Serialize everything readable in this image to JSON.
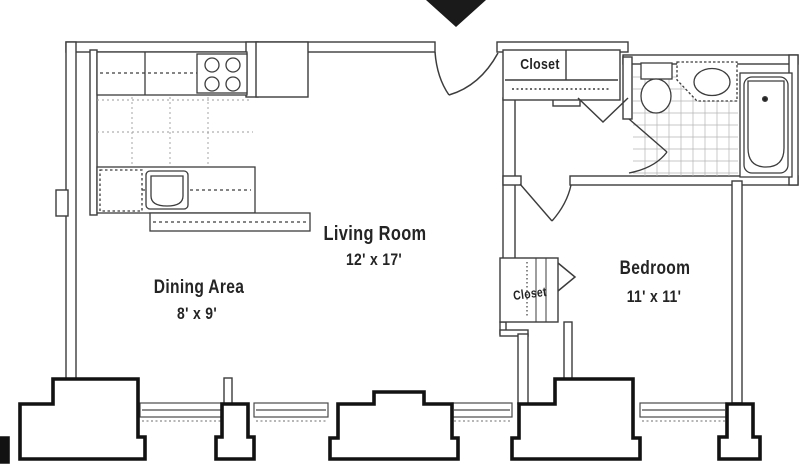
{
  "plan": {
    "title": "apartment-floor-plan",
    "rooms": [
      {
        "id": "living",
        "name": "Living Room",
        "dims": "12' x 17'"
      },
      {
        "id": "dining",
        "name": "Dining Area",
        "dims": "8' x 9'"
      },
      {
        "id": "bedroom",
        "name": "Bedroom",
        "dims": "11' x 11'"
      }
    ],
    "closets": {
      "entry_label": "Closet",
      "bedroom_label": "Closet"
    },
    "icons": {
      "entry_marker": "entry-arrow-icon",
      "stove": "stove-4-burner-icon",
      "kitchen_sink": "kitchen-sink-icon",
      "toilet": "toilet-icon",
      "bath_sink": "bathroom-sink-icon",
      "bathtub": "bathtub-icon",
      "doors": "door-swing-icon"
    },
    "colors": {
      "background": "#ffffff",
      "wall_line": "#3c3c3c",
      "exterior_block": "#121212",
      "tile_line": "#b5b5b5",
      "text": "#242424"
    }
  }
}
